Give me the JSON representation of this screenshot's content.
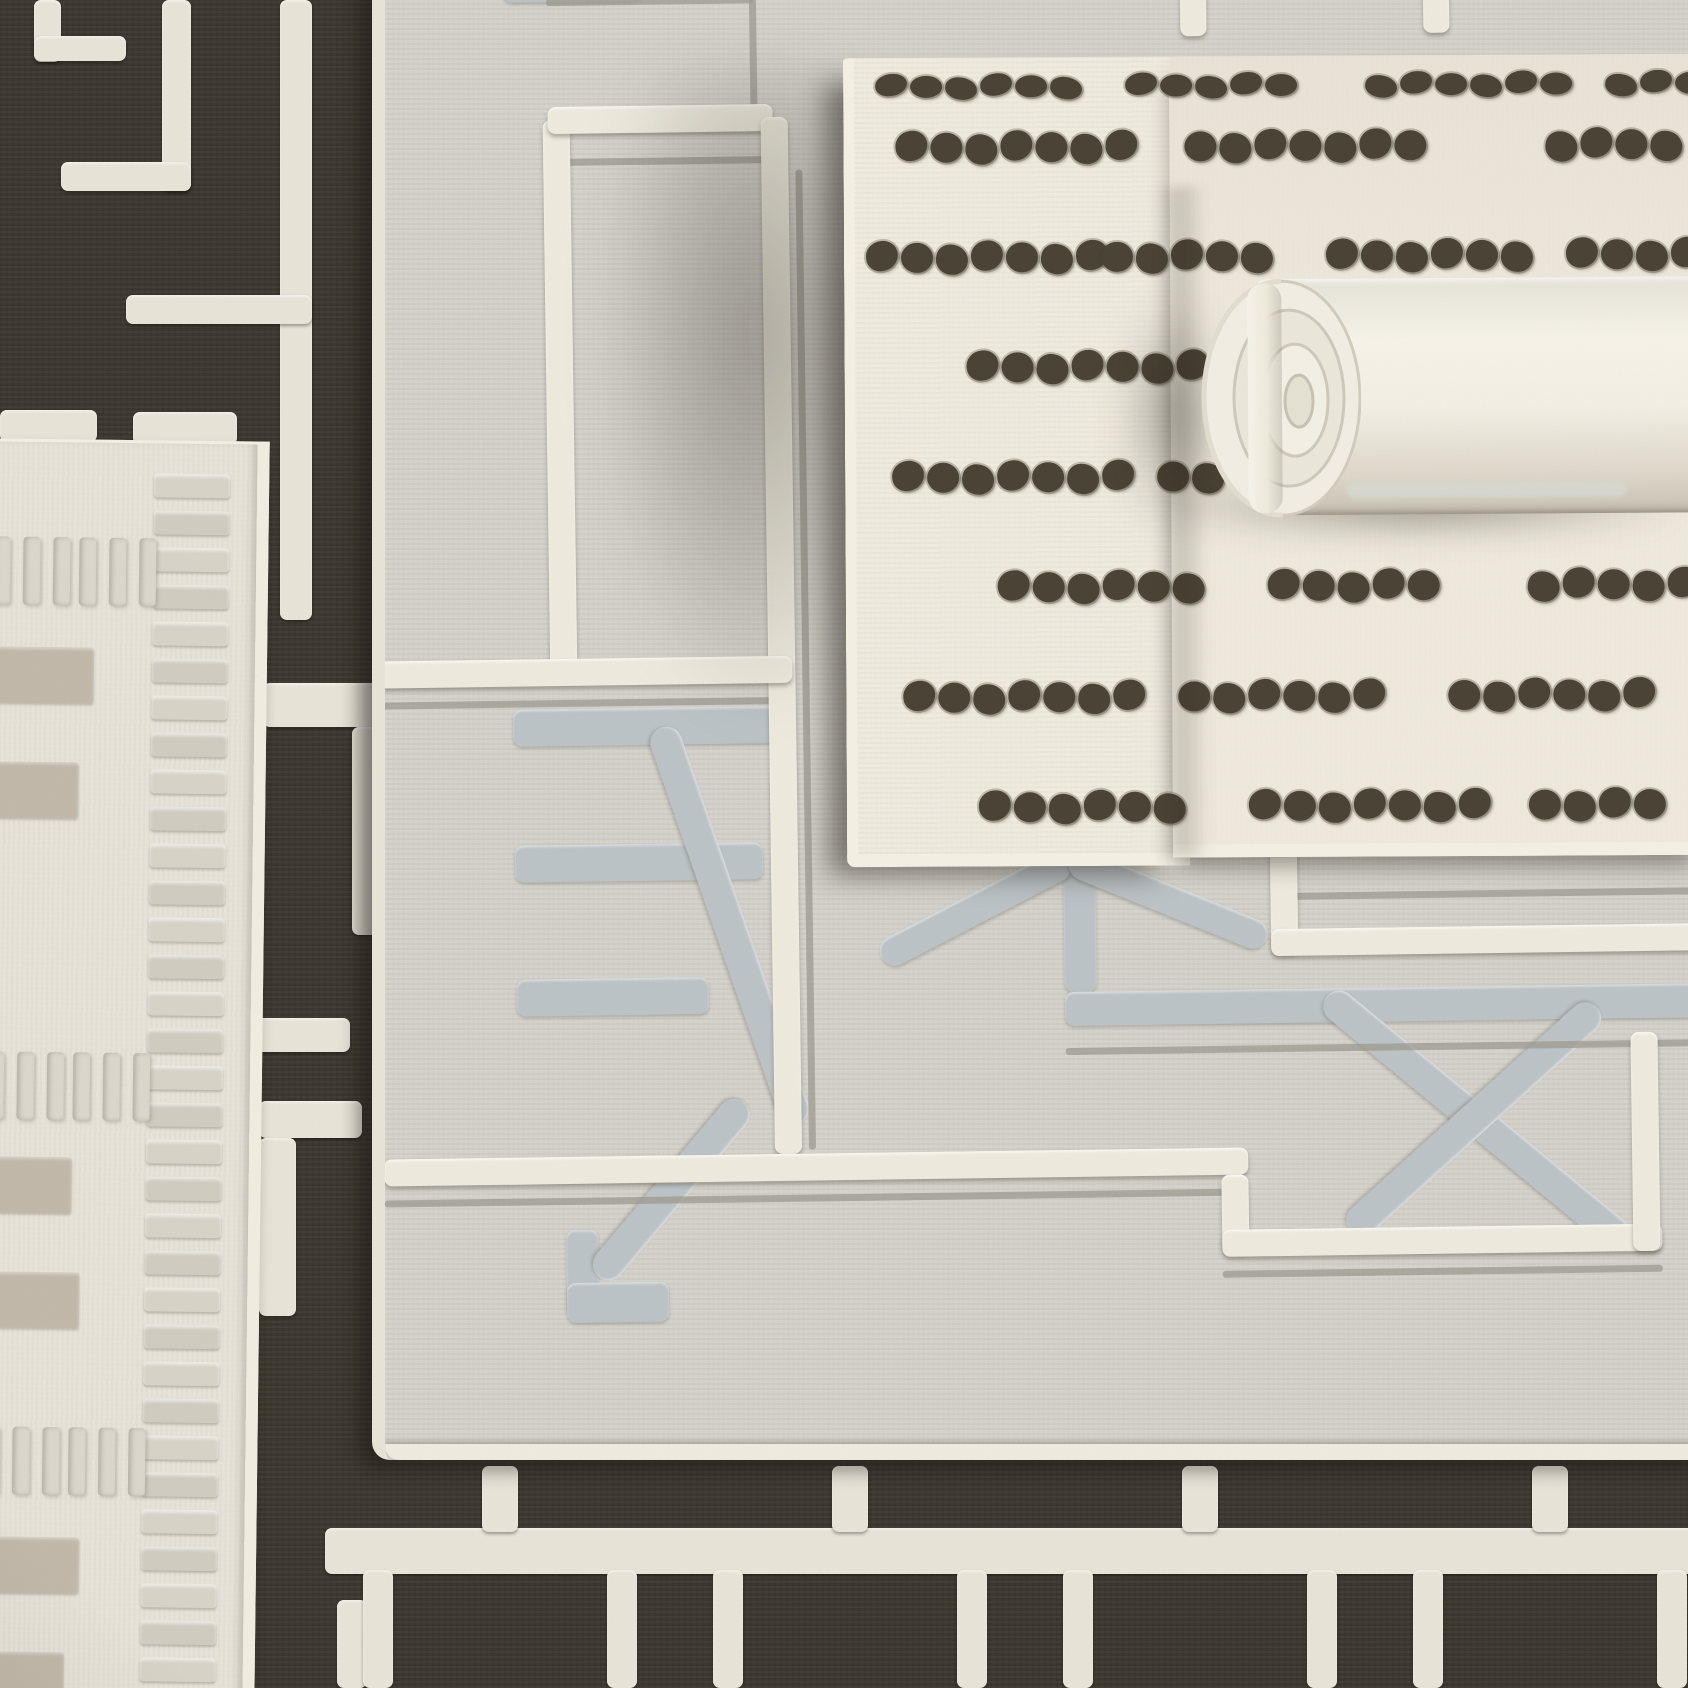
{
  "scene": {
    "width": 1688,
    "height": 1688,
    "kind": "photograph of four layered geometric rugs"
  },
  "palette": {
    "dark_rug": "#3b372e",
    "dark_rug_pattern": "#e9e5d9",
    "gray_rug_field": "#d5d3cb",
    "gray_rug_white_line": "#efecdf",
    "gray_rug_thin_line": "#9b998f",
    "gray_rug_motif": "#bdc4c7",
    "gray_rug_binding": "#e9e5d9",
    "gray_rug_cord": "#f0ede0",
    "dotted_rug_base": "#f1ece0",
    "dotted_rug_binding": "#f5f1e5",
    "dot_color": "#4a4234",
    "roll_base": "#f5f2e8",
    "left_rug_base": "#e8e4d9",
    "left_rug_rib": "#d8d4c8",
    "left_rug_bar": "#c3b9ab",
    "left_rug_dash": "#dcd8cd"
  },
  "dark_rug": {
    "pieces": [
      [
        34,
        0,
        27,
        62
      ],
      [
        34,
        36,
        92,
        25
      ],
      [
        162,
        0,
        29,
        191
      ],
      [
        61,
        162,
        130,
        29
      ],
      [
        280,
        0,
        32,
        620
      ],
      [
        126,
        295,
        186,
        29
      ],
      [
        0,
        410,
        97,
        32
      ],
      [
        133,
        412,
        104,
        33
      ],
      [
        263,
        683,
        124,
        44
      ],
      [
        352,
        727,
        35,
        208
      ],
      [
        253,
        1018,
        97,
        34
      ],
      [
        259,
        1101,
        103,
        37
      ],
      [
        259,
        1138,
        37,
        178
      ],
      [
        337,
        1600,
        30,
        88
      ]
    ],
    "bottom_bar": [
      325,
      1528,
      1380,
      46
    ],
    "bottom_stubs": {
      "y": 1466,
      "w": 36,
      "h": 66,
      "cx": [
        500,
        850,
        1200,
        1550
      ]
    },
    "bottom_rect_walls": {
      "y": 1570,
      "w": 30,
      "h": 118,
      "x_pairs": [
        [
          363,
          607
        ],
        [
          713,
          957
        ],
        [
          1063,
          1307
        ],
        [
          1413,
          1657
        ]
      ]
    }
  },
  "gray_rug": {
    "box": [
      372,
      -24,
      1360,
      1484
    ],
    "white_segments": [
      [
        186,
        157,
        27,
        557
      ],
      [
        191,
        144,
        225,
        27
      ],
      [
        404,
        157,
        27,
        1037
      ],
      [
        13,
        696,
        415,
        27
      ],
      [
        13,
        1194,
        864,
        27
      ],
      [
        850,
        1221,
        27,
        78
      ],
      [
        850,
        1276,
        440,
        27
      ],
      [
        1261,
        1084,
        27,
        219
      ],
      [
        903,
        869,
        27,
        131
      ],
      [
        903,
        976,
        800,
        27
      ],
      [
        825,
        0,
        26,
        82
      ],
      [
        1068,
        0,
        26,
        82
      ]
    ],
    "thin_segments": [
      [
        191,
        36,
        207,
        7
      ],
      [
        394,
        36,
        7,
        112
      ],
      [
        191,
        196,
        225,
        7
      ],
      [
        438,
        210,
        7,
        980
      ],
      [
        13,
        737,
        400,
        7
      ],
      [
        13,
        1235,
        864,
        7
      ],
      [
        850,
        1317,
        440,
        7
      ],
      [
        903,
        940,
        800,
        7
      ],
      [
        696,
        1092,
        970,
        7
      ]
    ],
    "gray_segments": [
      [
        148,
        0,
        140,
        39
      ],
      [
        696,
        874,
        32,
        162
      ],
      [
        696,
        1036,
        1010,
        34
      ]
    ],
    "motif_bars": [
      [
        148,
        746,
        280,
        37
      ],
      [
        148,
        882,
        248,
        37
      ],
      [
        148,
        1016,
        192,
        37
      ],
      [
        194,
        1267,
        32,
        87
      ],
      [
        194,
        1320,
        102,
        40
      ]
    ],
    "motif_diagonals": [
      {
        "from": [
          296,
          766
        ],
        "to": [
          428,
          1164
        ],
        "w": 32
      },
      {
        "from": [
          374,
          1142
        ],
        "to": [
          226,
          1314
        ],
        "w": 32
      },
      {
        "from": [
          513,
          999
        ],
        "to": [
          703,
          904
        ],
        "w": 30
      },
      {
        "from": [
          703,
          904
        ],
        "to": [
          898,
          986
        ],
        "w": 30
      },
      {
        "from": [
          958,
          1044
        ],
        "to": [
          1253,
          1294
        ],
        "w": 32
      },
      {
        "from": [
          1228,
          1059
        ],
        "to": [
          978,
          1279
        ],
        "w": 32
      }
    ]
  },
  "dotted_rug": {
    "box": [
      845,
      56,
      860,
      800
    ],
    "rotate": -0.3,
    "left_part": [
      0,
      0,
      332,
      796
    ],
    "right_part": [
      326,
      0,
      534,
      788
    ],
    "dot": {
      "w": 32,
      "h": 30,
      "pitch": 35
    },
    "rows": [
      {
        "y": 18,
        "h": 22,
        "groups": [
          [
            30,
            6
          ],
          [
            280,
            5
          ],
          [
            520,
            6
          ],
          [
            760,
            3
          ]
        ]
      },
      {
        "y": 75,
        "h": 30,
        "groups": [
          [
            50,
            7
          ],
          [
            339,
            7
          ],
          [
            700,
            4
          ]
        ]
      },
      {
        "y": 185,
        "h": 30,
        "groups": [
          [
            20,
            7
          ],
          [
            255,
            5
          ],
          [
            480,
            6
          ],
          [
            720,
            4
          ]
        ]
      },
      {
        "y": 295,
        "h": 30,
        "groups": [
          [
            120,
            7
          ],
          [
            400,
            6
          ],
          [
            660,
            5
          ]
        ]
      },
      {
        "y": 405,
        "h": 30,
        "groups": [
          [
            45,
            7
          ],
          [
            310,
            7
          ],
          [
            580,
            5
          ],
          [
            800,
            2
          ]
        ]
      },
      {
        "y": 515,
        "h": 30,
        "groups": [
          [
            150,
            6
          ],
          [
            420,
            5
          ],
          [
            680,
            5
          ]
        ]
      },
      {
        "y": 625,
        "h": 30,
        "groups": [
          [
            55,
            7
          ],
          [
            330,
            6
          ],
          [
            600,
            6
          ]
        ]
      },
      {
        "y": 735,
        "h": 30,
        "groups": [
          [
            130,
            6
          ],
          [
            400,
            7
          ],
          [
            680,
            4
          ]
        ]
      }
    ]
  },
  "roll": {
    "box": [
      1196,
      276,
      512,
      242
    ],
    "rotate": -0.4,
    "body": [
      58,
      2,
      454,
      236
    ],
    "wrap_edge": [
      52,
      6,
      34,
      230
    ],
    "stripe": [
      150,
      206,
      280,
      16
    ]
  },
  "left_rug": {
    "box": [
      -15,
      440,
      265,
      1260
    ],
    "rotate": 0.7,
    "ribs": {
      "x": 162,
      "w": 76,
      "h": 24,
      "gap": 13,
      "top": 30
    },
    "dash_rows": {
      "y": [
        95,
        610,
        985
      ],
      "group_x": [
        2,
        88
      ],
      "dash_w": 17,
      "dash_h": 68,
      "dash_gap": 13,
      "n": 3
    },
    "bars": [
      {
        "y": 205,
        "w": 104
      },
      {
        "y": 320,
        "w": 90
      },
      {
        "y": 715,
        "w": 88
      },
      {
        "y": 830,
        "w": 97
      },
      {
        "y": 1095,
        "w": 100
      },
      {
        "y": 1210,
        "w": 86
      }
    ]
  },
  "shadows": {
    "edge_blob": [
      595,
      70,
      270,
      660
    ],
    "roll_under": [
      1135,
      470,
      560,
      70
    ],
    "roll_cap_blob": [
      1118,
      295,
      110,
      240
    ],
    "crease_band": [
      310,
      130,
      54,
      670
    ]
  }
}
